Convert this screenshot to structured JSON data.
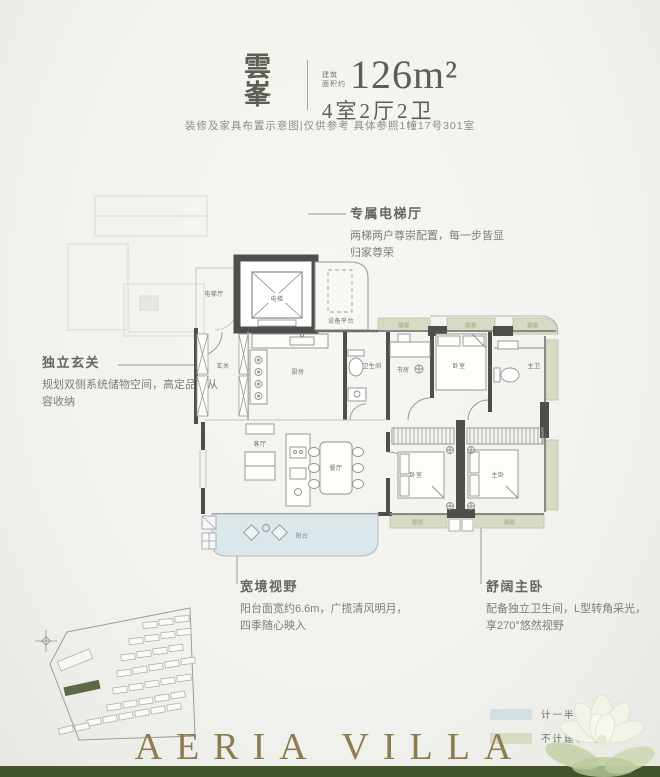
{
  "header": {
    "name_char1": "雲",
    "name_char2": "峯",
    "area_label_line1": "建筑",
    "area_label_line2": "面积约",
    "area_value": "126m²",
    "rooms_spec": "4室2厅2卫",
    "disclaimer": "装修及家具布置示意图|仅供参考 具体参照1幢17号301室"
  },
  "annotations": {
    "elevator": {
      "title": "专属电梯厅",
      "line1": "两梯两户尊崇配置，每一步皆显",
      "line2": "归家尊荣"
    },
    "foyer": {
      "title": "独立玄关",
      "line1": "规划双侧系统储物空间，高定品位从",
      "line2": "容收纳"
    },
    "view": {
      "title": "宽境视野",
      "line1": "阳台面宽约6.6m，广揽清风明月，",
      "line2": "四季随心映入"
    },
    "master": {
      "title": "舒阔主卧",
      "line1": "配备独立卫生间，L型转角采光，",
      "line2": "享270°悠然视野"
    }
  },
  "rooms": {
    "elevator_hall": "电梯厅",
    "elevator": "电梯",
    "equipment_platform": "设备平台",
    "foyer": "玄关",
    "kitchen": "厨房",
    "bathroom": "卫生间",
    "study": "书房",
    "bedroom": "卧室",
    "master_bathroom": "主卫",
    "living_room": "客厅",
    "dining_room": "餐厅",
    "master_bedroom": "主卧",
    "balcony": "阳台",
    "bay_window": "飘窗"
  },
  "legend": {
    "items": [
      {
        "label": "计一半建筑面积",
        "color": "#d4dfe4"
      },
      {
        "label": "不计建筑面积",
        "color": "#d6dcc4"
      }
    ]
  },
  "footer": {
    "brand": "AERIA VILLA"
  },
  "colors": {
    "background": "#f2f1ed",
    "wall": "#4e4f4c",
    "balcony_fill": "#dce7ec",
    "bay_window_fill": "#d6dcc4",
    "accent_text": "#5a5f52",
    "bottom_bar": "#42552c",
    "brand_latin": "#8d7c50",
    "site_highlight": "#5b6a42"
  }
}
